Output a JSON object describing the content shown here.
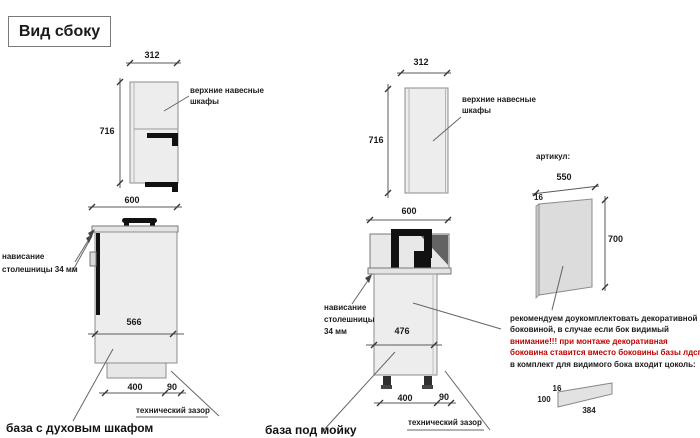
{
  "title": "Вид сбоку",
  "left_section": {
    "upper_cabinet": {
      "width_mm": "312",
      "height_mm": "716",
      "label_line1": "верхние навесные",
      "label_line2": "шкафы"
    },
    "base_cabinet": {
      "width_mm": "600",
      "niche_mm": "566",
      "plinth_mm": "400",
      "gap_mm": "90",
      "overhang_line1": "нависание",
      "overhang_line2": "столешницы 34 мм",
      "gap_label": "технический зазор",
      "caption": "база с духовым шкафом"
    }
  },
  "middle_section": {
    "upper_cabinet": {
      "width_mm": "312",
      "height_mm": "716",
      "label_line1": "верхние навесные",
      "label_line2": "шкафы"
    },
    "base_cabinet": {
      "width_mm": "600",
      "niche_mm": "476",
      "plinth_mm": "400",
      "gap_mm": "90",
      "overhang_line1": "нависание",
      "overhang_line2": "столешницы",
      "overhang_line3": "34 мм",
      "gap_label": "технический зазор",
      "caption": "база под мойку"
    }
  },
  "right_section": {
    "heading": "артикул:",
    "side_panel": {
      "width_mm": "550",
      "thickness_mm": "16",
      "height_mm": "700"
    },
    "note": {
      "line1": "рекомендуем доукомплектовать декоративной",
      "line2": "боковиной, в случае если бок видимый",
      "warning1": "внимание!!! при монтаже декоративная",
      "warning2": "боковина ставится вместо боковины базы лдсп",
      "line3": "в комплект для видимого бока входит цоколь:",
      "warning_color": "#c00000"
    },
    "plinth": {
      "thickness_mm": "16",
      "height_mm": "100",
      "length_mm": "384"
    }
  }
}
